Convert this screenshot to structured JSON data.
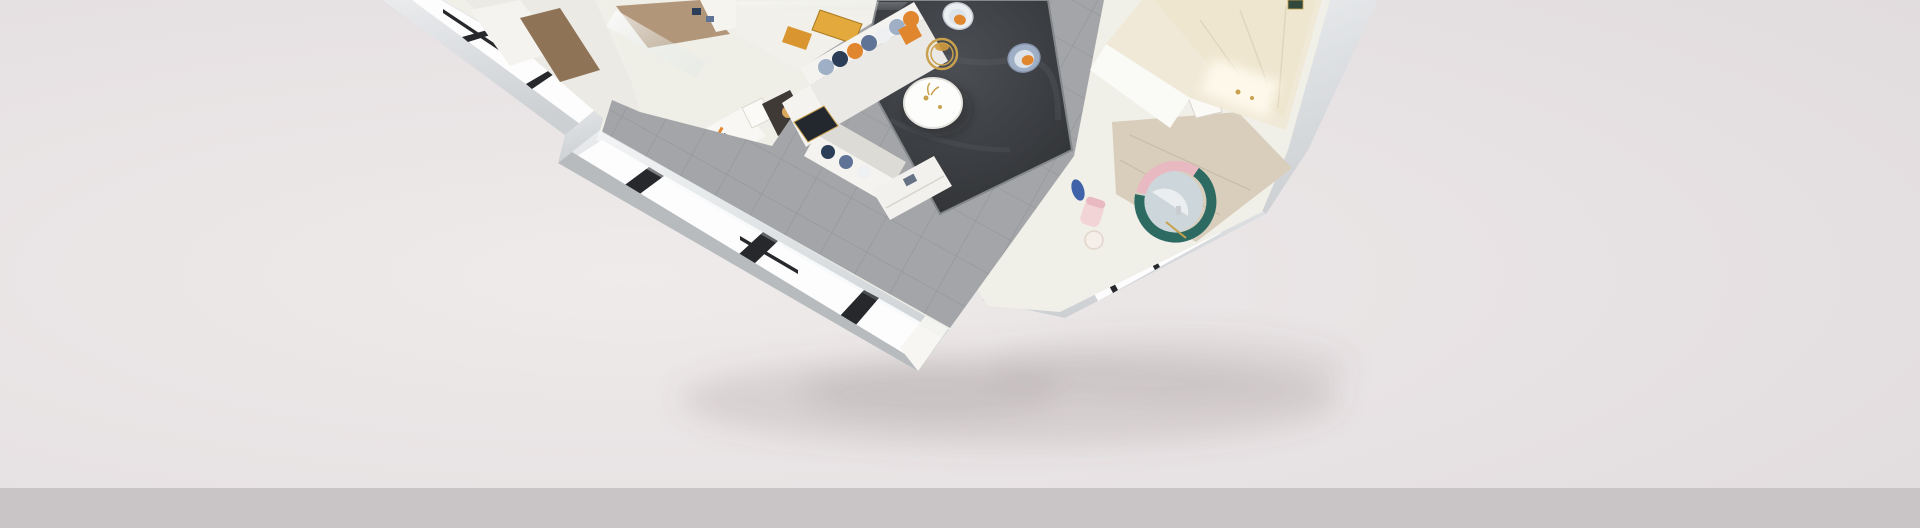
{
  "scene": {
    "kind": "isometric-apartment-cutaway-3d-render",
    "rooms": [
      "bedroom",
      "foyer-hallway",
      "living-dining-room",
      "balcony-window-wall",
      "nursery-bathroom",
      "cloakroom-closet"
    ],
    "furniture": [
      "sectional-sofa",
      "accent-chairs",
      "round-coffee-table",
      "gold-ring-side-table",
      "dark-area-rug",
      "tv-cabinet",
      "bookshelf",
      "wardrobe",
      "floor-lamp",
      "round-crib-rug",
      "entry-doormat"
    ]
  },
  "colors": {
    "background_center": "#efebea",
    "background_mid": "#e8e3e4",
    "background_edge": "#e1dcde",
    "bottom_band": "#c9c4c5",
    "shadow": "#6e6466",
    "wall_top": "#f0efe8",
    "wall_white": "#f7f6f2",
    "face_light": "#e9ebed",
    "face_mid": "#cdd0d3",
    "face_dark": "#b8bcbf",
    "pane": "#fdfdfe",
    "frame": "#26282b",
    "glass": "#d8e4e3",
    "tile": "#a3a5a8",
    "tile_line": "#74777a",
    "rug_mid": "#4b4e53",
    "rug_dark": "#2c2e31",
    "wood": "#b29679",
    "wood_light": "#d9cebc",
    "sofa": "#f4f3f0",
    "sofa_shade": "#dddbd5",
    "orange": "#e0862e",
    "blue_light": "#9fb0c6",
    "blue_steel": "#5f7396",
    "navy": "#2c3d57",
    "gold": "#c9a14e",
    "cream_cabinet": "#f1e9d8",
    "cream_lit": "#fdf8ea",
    "teal": "#2d6a62",
    "pink": "#e9b9c1",
    "pink_light": "#f2d4d6",
    "blue_disc": "#3f62a8",
    "rug_inner": "#cdd6da",
    "lamp": "#d9a75e",
    "wardrobe_brown": "#8e7356",
    "mat_dark": "#23272e",
    "art_gold": "#e3a93c",
    "art_amber": "#d9952f"
  }
}
